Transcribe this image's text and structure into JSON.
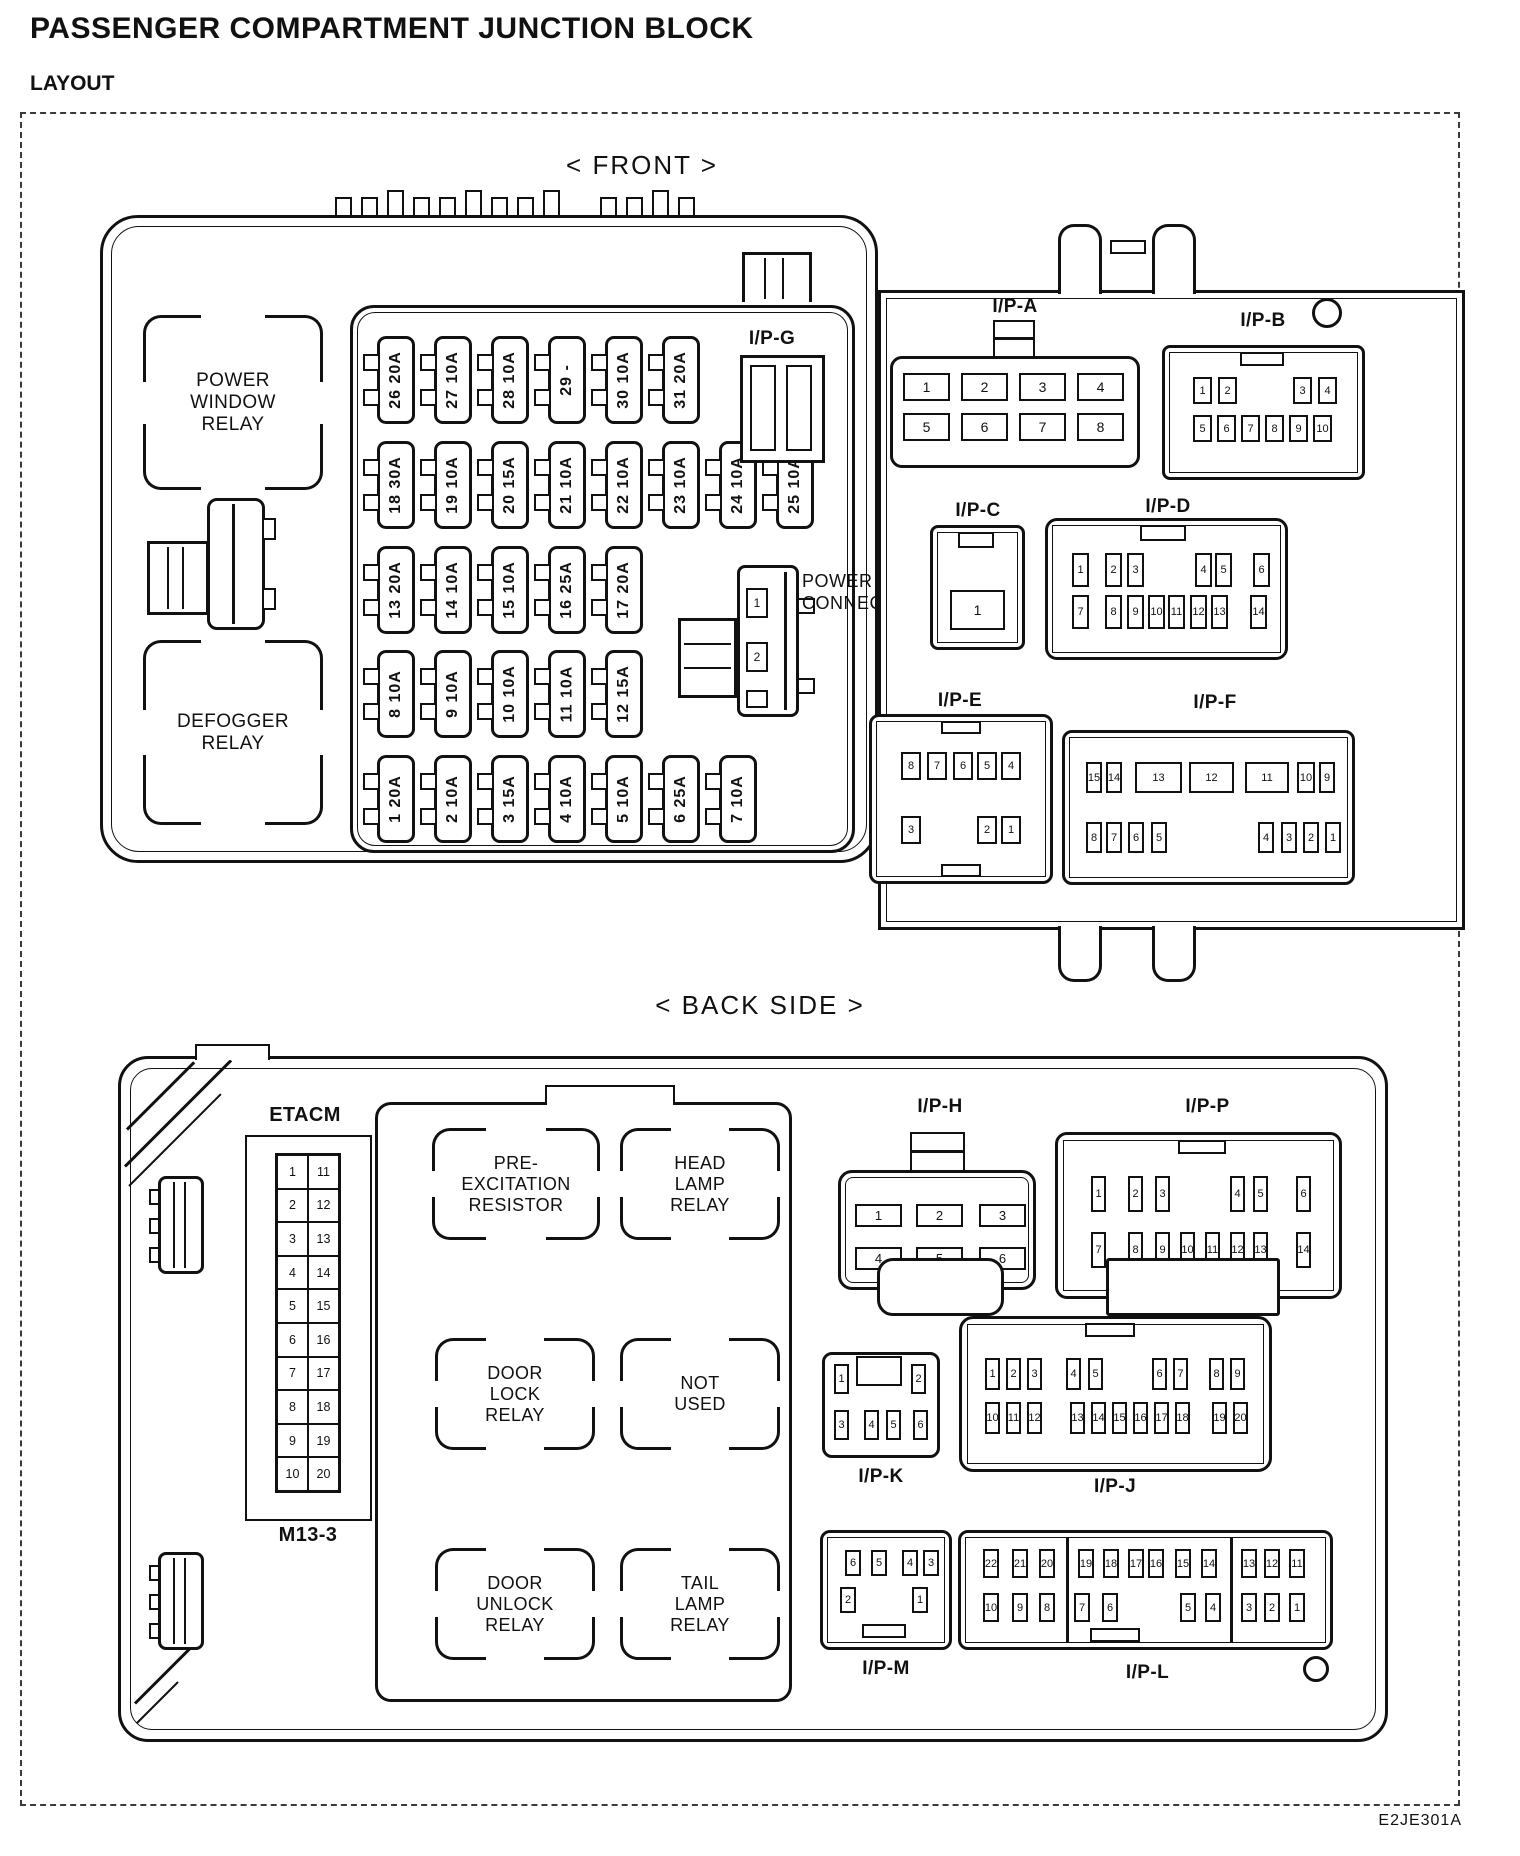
{
  "page": {
    "title": "PASSENGER COMPARTMENT JUNCTION BLOCK",
    "subtitle": "LAYOUT",
    "front_heading": "< FRONT >",
    "back_heading": "< BACK SIDE >",
    "code": "E2JE301A"
  },
  "front": {
    "power_window_relay": [
      "POWER",
      "WINDOW",
      "RELAY"
    ],
    "defogger_relay": [
      "DEFOGGER",
      "RELAY"
    ],
    "power_connector_label": [
      "POWER",
      "CONNECTOR"
    ],
    "power_connector_pins": [
      {
        "t": "1"
      },
      {
        "t": "2",
        "mt": 24
      }
    ],
    "fuse_rows": [
      [
        {
          "t": "26 20A"
        },
        {
          "t": "27 10A"
        },
        {
          "t": "28 10A"
        },
        {
          "t": "29 -"
        },
        {
          "t": "30 10A"
        },
        {
          "t": "31 20A"
        }
      ],
      [
        {
          "t": "18 30A"
        },
        {
          "t": "19 10A"
        },
        {
          "t": "20 15A"
        },
        {
          "t": "21 10A"
        },
        {
          "t": "22 10A"
        },
        {
          "t": "23 10A"
        },
        {
          "t": "24 10A"
        },
        {
          "t": "25 10A"
        }
      ],
      [
        {
          "t": "13 20A"
        },
        {
          "t": "14 10A"
        },
        {
          "t": "15 10A"
        },
        {
          "t": "16 25A"
        },
        {
          "t": "17 20A"
        }
      ],
      [
        {
          "t": "8 10A"
        },
        {
          "t": "9 10A"
        },
        {
          "t": "10 10A"
        },
        {
          "t": "11 10A"
        },
        {
          "t": "12 15A"
        }
      ],
      [
        {
          "t": "1 20A"
        },
        {
          "t": "2 10A"
        },
        {
          "t": "3 15A"
        },
        {
          "t": "4 10A"
        },
        {
          "t": "5 10A"
        },
        {
          "t": "6 25A"
        },
        {
          "t": "7 10A"
        }
      ]
    ],
    "connectors": {
      "ipg": {
        "label": "I/P-G"
      },
      "ipa": {
        "label": "I/P-A",
        "row1": [
          {
            "t": "1"
          },
          {
            "t": "2",
            "ml": 11
          },
          {
            "t": "3",
            "ml": 11
          },
          {
            "t": "4",
            "ml": 11
          }
        ],
        "row2": [
          {
            "t": "5"
          },
          {
            "t": "6",
            "ml": 11
          },
          {
            "t": "7",
            "ml": 11
          },
          {
            "t": "8",
            "ml": 11
          }
        ]
      },
      "ipb": {
        "label": "I/P-B",
        "row1": [
          {
            "t": "1"
          },
          {
            "t": "2",
            "ml": 6
          },
          {
            "t": "3",
            "ml": 56
          },
          {
            "t": "4",
            "ml": 6
          }
        ],
        "row2": [
          {
            "t": "5"
          },
          {
            "t": "6",
            "ml": 5
          },
          {
            "t": "7",
            "ml": 5
          },
          {
            "t": "8",
            "ml": 5
          },
          {
            "t": "9",
            "ml": 5
          },
          {
            "t": "10",
            "ml": 5
          }
        ]
      },
      "ipc": {
        "label": "I/P-C",
        "pin": "1"
      },
      "ipd": {
        "label": "I/P-D",
        "row1": [
          {
            "t": "1"
          },
          {
            "t": "2",
            "ml": 16
          },
          {
            "t": "3",
            "ml": 5
          },
          {
            "t": "4",
            "ml": 51
          },
          {
            "t": "5",
            "ml": 3
          },
          {
            "t": "6",
            "ml": 21
          }
        ],
        "row2": [
          {
            "t": "7"
          },
          {
            "t": "8",
            "ml": 16
          },
          {
            "t": "9",
            "ml": 5
          },
          {
            "t": "10",
            "ml": 4
          },
          {
            "t": "11",
            "ml": 3
          },
          {
            "t": "12",
            "ml": 5
          },
          {
            "t": "13",
            "ml": 4
          },
          {
            "t": "14",
            "ml": 22
          }
        ]
      },
      "ipe": {
        "label": "I/P-E",
        "row1": [
          {
            "t": "8"
          },
          {
            "t": "7",
            "ml": 6
          },
          {
            "t": "6",
            "ml": 6
          },
          {
            "t": "5",
            "ml": 4
          },
          {
            "t": "4",
            "ml": 4
          }
        ],
        "row2": [
          {
            "t": "3"
          },
          {
            "t": "2",
            "ml": 56
          },
          {
            "t": "1",
            "ml": 4
          }
        ]
      },
      "ipf": {
        "label": "I/P-F",
        "row1": [
          {
            "t": "15"
          },
          {
            "t": "14",
            "ml": 4
          },
          {
            "t": "13",
            "ml": 13,
            "w": 47
          },
          {
            "t": "12",
            "ml": 7,
            "w": 45
          },
          {
            "t": "11",
            "ml": 11,
            "w": 44
          },
          {
            "t": "10",
            "ml": 8,
            "w": 18
          },
          {
            "t": "9",
            "ml": 4
          }
        ],
        "row2": [
          {
            "t": "8"
          },
          {
            "t": "7",
            "ml": 4
          },
          {
            "t": "6",
            "ml": 6
          },
          {
            "t": "5",
            "ml": 7
          },
          {
            "t": "4",
            "ml": 91
          },
          {
            "t": "3",
            "ml": 7
          },
          {
            "t": "2",
            "ml": 6
          },
          {
            "t": "1",
            "ml": 6
          }
        ]
      }
    }
  },
  "back": {
    "etacm_label": "ETACM",
    "etacm_code": "M13-3",
    "etacm_rows": [
      {
        "l": "1",
        "r": "11"
      },
      {
        "l": "2",
        "r": "12"
      },
      {
        "l": "3",
        "r": "13"
      },
      {
        "l": "4",
        "r": "14"
      },
      {
        "l": "5",
        "r": "15"
      },
      {
        "l": "6",
        "r": "16"
      },
      {
        "l": "7",
        "r": "17"
      },
      {
        "l": "8",
        "r": "18"
      },
      {
        "l": "9",
        "r": "19"
      },
      {
        "l": "10",
        "r": "20"
      }
    ],
    "relays": {
      "pre_excitation": [
        "PRE-",
        "EXCITATION",
        "RESISTOR"
      ],
      "head_lamp": [
        "HEAD",
        "LAMP",
        "RELAY"
      ],
      "door_lock": [
        "DOOR",
        "LOCK",
        "RELAY"
      ],
      "not_used": [
        "NOT",
        "USED"
      ],
      "door_unlock": [
        "DOOR",
        "UNLOCK",
        "RELAY"
      ],
      "tail_lamp": [
        "TAIL",
        "LAMP",
        "RELAY"
      ]
    },
    "connectors": {
      "iph": {
        "label": "I/P-H",
        "row1": [
          {
            "t": "1"
          },
          {
            "t": "2",
            "ml": 14
          },
          {
            "t": "3",
            "ml": 16
          }
        ],
        "row2": [
          {
            "t": "4"
          },
          {
            "t": "5",
            "ml": 14
          },
          {
            "t": "6",
            "ml": 16
          }
        ]
      },
      "ipp": {
        "label": "I/P-P",
        "row1": [
          {
            "t": "1"
          },
          {
            "t": "2",
            "ml": 22
          },
          {
            "t": "3",
            "ml": 12
          },
          {
            "t": "4",
            "ml": 60
          },
          {
            "t": "5",
            "ml": 8
          },
          {
            "t": "6",
            "ml": 28
          }
        ],
        "row2": [
          {
            "t": "7"
          },
          {
            "t": "8",
            "ml": 22
          },
          {
            "t": "9",
            "ml": 12
          },
          {
            "t": "10",
            "ml": 10
          },
          {
            "t": "11",
            "ml": 10
          },
          {
            "t": "12",
            "ml": 10
          },
          {
            "t": "13",
            "ml": 8
          },
          {
            "t": "14",
            "ml": 28
          }
        ]
      },
      "ipk": {
        "label": "I/P-K",
        "row1": [
          {
            "t": "1"
          },
          {
            "t": "2",
            "ml": 62
          }
        ],
        "row2": [
          {
            "t": "3"
          },
          {
            "t": "4",
            "ml": 15
          },
          {
            "t": "5",
            "ml": 7
          },
          {
            "t": "6",
            "ml": 12
          }
        ]
      },
      "ipj": {
        "label": "I/P-J",
        "row1": [
          {
            "t": "1"
          },
          {
            "t": "2",
            "ml": 6
          },
          {
            "t": "3",
            "ml": 6
          },
          {
            "t": "4",
            "ml": 24
          },
          {
            "t": "5",
            "ml": 7
          },
          {
            "t": "6",
            "ml": 49
          },
          {
            "t": "7",
            "ml": 6
          },
          {
            "t": "8",
            "ml": 21
          },
          {
            "t": "9",
            "ml": 6
          }
        ],
        "row2": [
          {
            "t": "10"
          },
          {
            "t": "11",
            "ml": 6
          },
          {
            "t": "12",
            "ml": 6
          },
          {
            "t": "13",
            "ml": 28
          },
          {
            "t": "14",
            "ml": 6
          },
          {
            "t": "15",
            "ml": 6
          },
          {
            "t": "16",
            "ml": 6
          },
          {
            "t": "17",
            "ml": 6
          },
          {
            "t": "18",
            "ml": 6
          },
          {
            "t": "19",
            "ml": 22
          },
          {
            "t": "20",
            "ml": 6
          }
        ]
      },
      "ipm": {
        "label": "I/P-M",
        "row1": [
          {
            "t": "6"
          },
          {
            "t": "5",
            "ml": 10
          },
          {
            "t": "4",
            "ml": 15
          },
          {
            "t": "3",
            "ml": 5
          }
        ],
        "row2": [
          {
            "t": "2"
          },
          {
            "t": "1",
            "ml": 56
          }
        ]
      },
      "ipl": {
        "label": "I/P-L",
        "row1": [
          {
            "t": "22"
          },
          {
            "t": "21",
            "ml": 13
          },
          {
            "t": "20",
            "ml": 11
          },
          {
            "t": "19",
            "ml": 23
          },
          {
            "t": "18",
            "ml": 9
          },
          {
            "t": "17",
            "ml": 9
          },
          {
            "t": "16",
            "ml": 4
          },
          {
            "t": "15",
            "ml": 11
          },
          {
            "t": "14",
            "ml": 10
          },
          {
            "t": "13",
            "ml": 24
          },
          {
            "t": "12",
            "ml": 7
          },
          {
            "t": "11",
            "ml": 9
          }
        ],
        "row2": [
          {
            "t": "10"
          },
          {
            "t": "9",
            "ml": 13
          },
          {
            "t": "8",
            "ml": 11
          },
          {
            "t": "7",
            "ml": 19
          },
          {
            "t": "6",
            "ml": 12
          },
          {
            "t": "5",
            "ml": 62
          },
          {
            "t": "4",
            "ml": 9
          },
          {
            "t": "3",
            "ml": 20
          },
          {
            "t": "2",
            "ml": 7
          },
          {
            "t": "1",
            "ml": 9
          }
        ]
      }
    }
  }
}
